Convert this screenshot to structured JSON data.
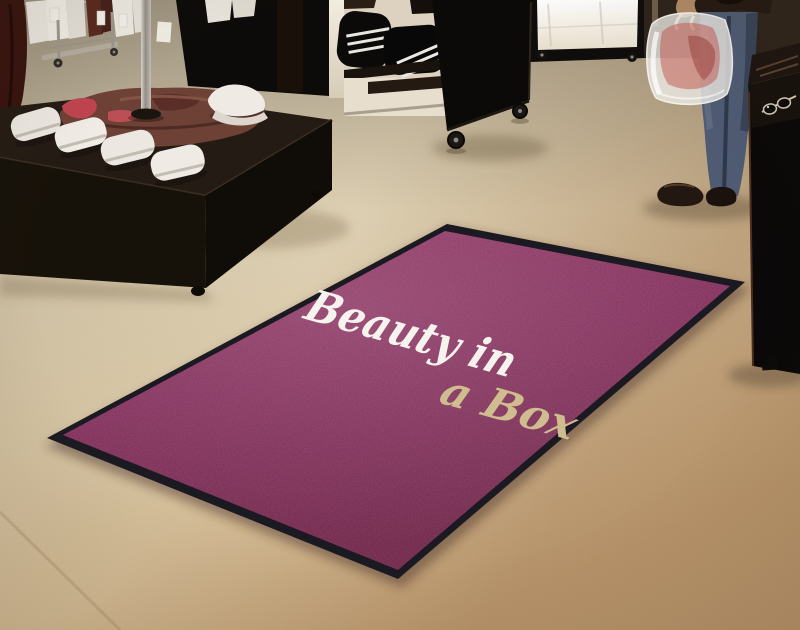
{
  "mat": {
    "line1": "Beauty in",
    "line2": "a Box",
    "colors": {
      "surface": "#8e2c60",
      "border": "#1b1a22",
      "line1_text": "#f6f3ee",
      "line2_text": "#cfbd90"
    }
  },
  "scene": {
    "floor_color": "#d3bd97",
    "objects": [
      "clothing-rack-with-shirts",
      "dark-display-table",
      "white-sneakers",
      "apparel-pile",
      "baseball-cap",
      "garment-pole",
      "black-back-panel",
      "shelf-unit-with-duffel-bags",
      "black-rolling-cart",
      "illuminated-display-case",
      "shopper-with-plastic-bag",
      "dark-counter-with-sunglasses",
      "logo-floor-mat"
    ]
  }
}
